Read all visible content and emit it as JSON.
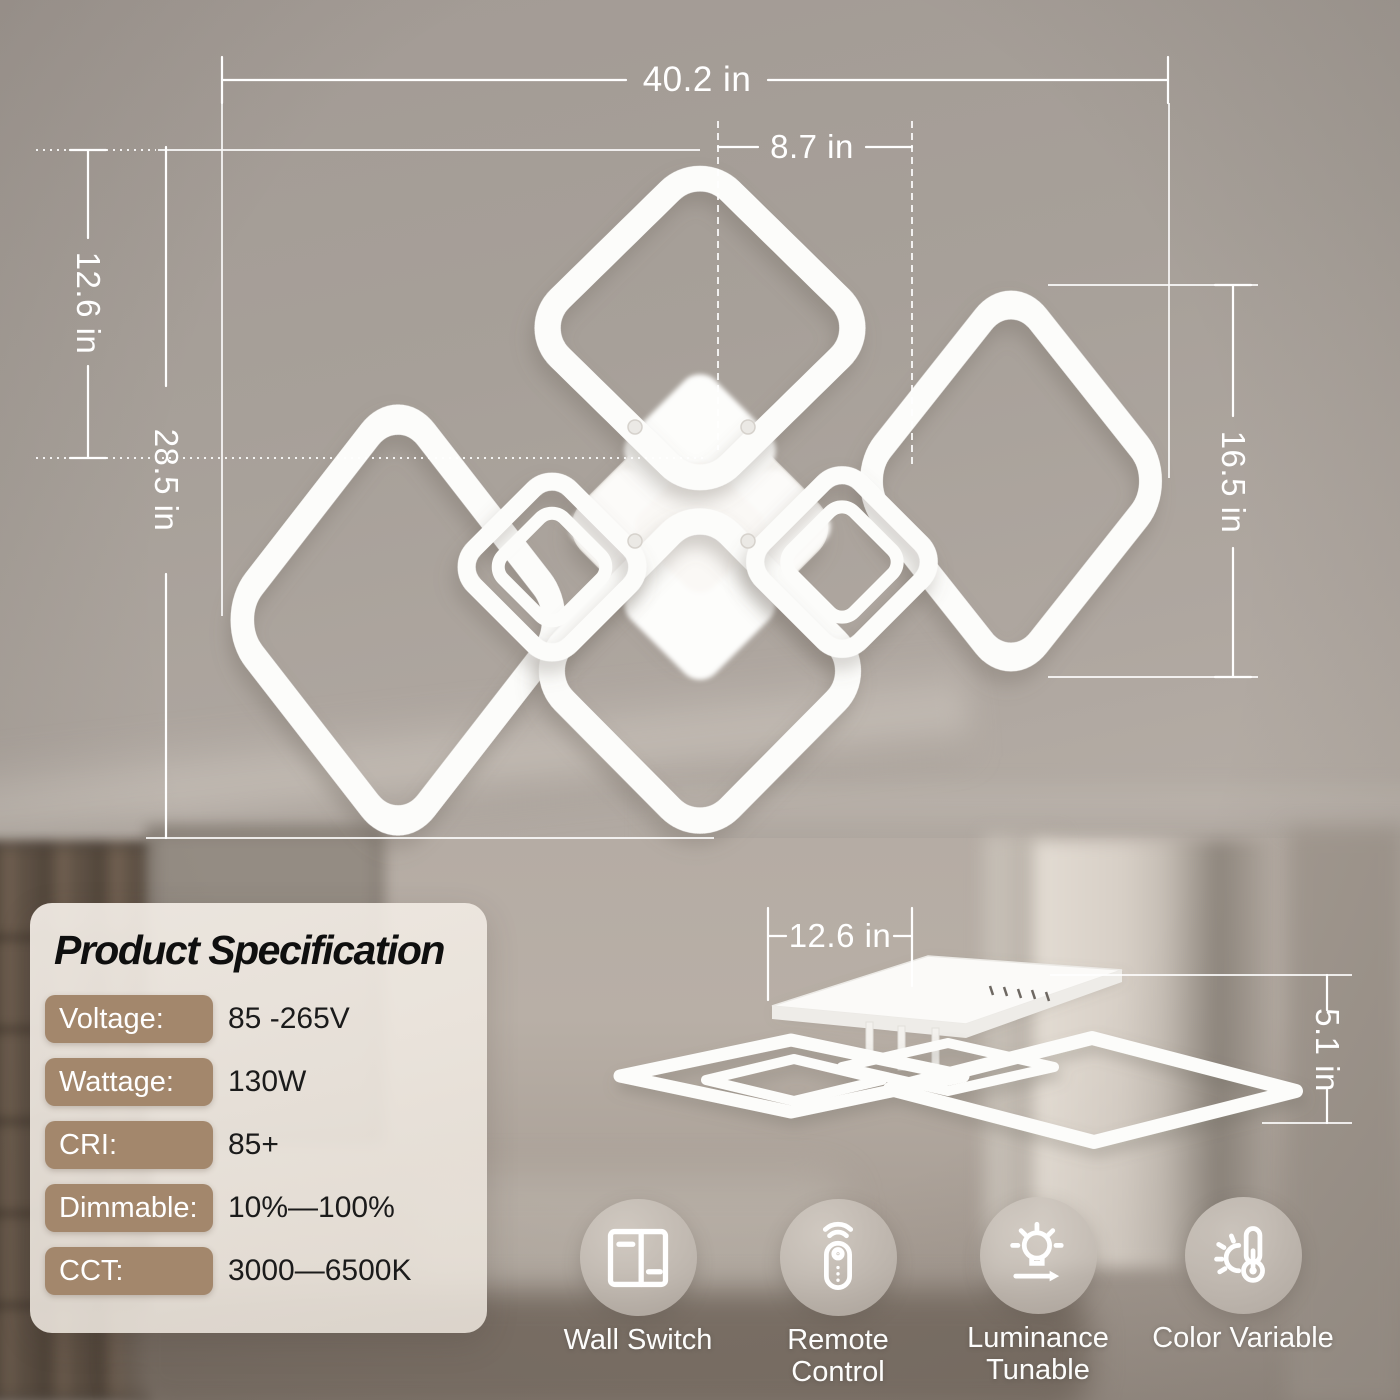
{
  "colors": {
    "accent_tan": "#a3876c",
    "dimension_line": "#ffffff",
    "spec_title_text": "#0f0f0f",
    "spec_value_text": "#1b1b1b",
    "feature_label_text": "#fdfdfc"
  },
  "dimensions": {
    "front": {
      "overall_width": "40.2 in",
      "center_width": "8.7 in",
      "upper_height": "12.6 in",
      "overall_height": "28.5 in",
      "side_ring_height": "16.5 in"
    },
    "side": {
      "canopy_width": "12.6 in",
      "fixture_height": "5.1 in"
    }
  },
  "spec_panel": {
    "title": "Product Specification",
    "rows": [
      {
        "label": "Voltage:",
        "value": "85 -265V"
      },
      {
        "label": "Wattage:",
        "value": "130W"
      },
      {
        "label": "CRI:",
        "value": "85+"
      },
      {
        "label": "Dimmable:",
        "value": "10%—100%"
      },
      {
        "label": "CCT:",
        "value": "3000—6500K"
      }
    ]
  },
  "features": [
    {
      "icon": "wall-switch-icon",
      "lines": [
        "Wall Switch",
        ""
      ]
    },
    {
      "icon": "remote-control-icon",
      "lines": [
        "Remote",
        "Control"
      ]
    },
    {
      "icon": "luminance-tunable-icon",
      "lines": [
        "Luminance",
        "Tunable"
      ]
    },
    {
      "icon": "color-variable-icon",
      "lines": [
        "Color Variable",
        ""
      ]
    }
  ]
}
